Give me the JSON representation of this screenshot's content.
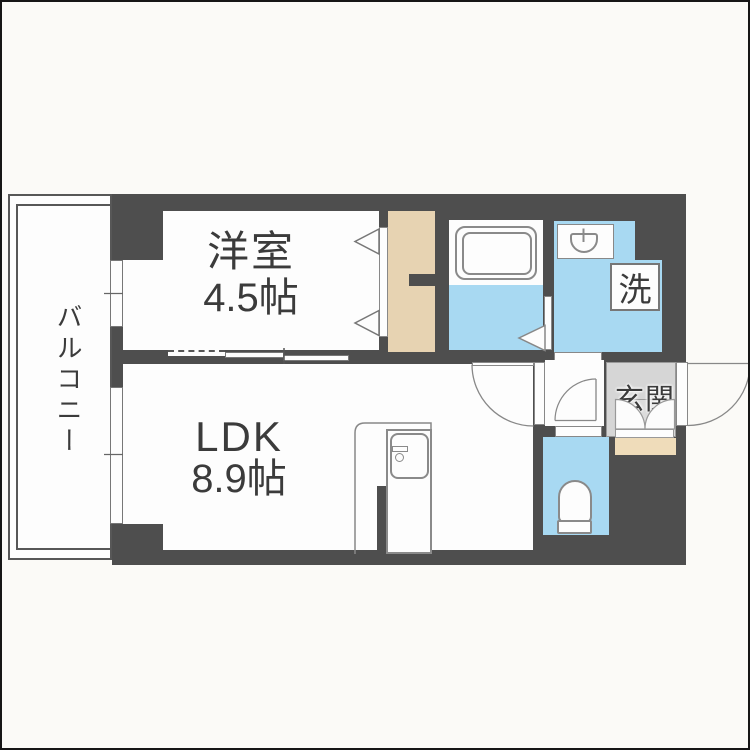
{
  "plan": {
    "bedroom": {
      "name": "洋室",
      "area": "4.5帖"
    },
    "ldk": {
      "name": "LDK",
      "area": "8.9帖"
    },
    "balcony": {
      "name": "バルコニー"
    },
    "entrance": {
      "name": "玄関"
    },
    "laundry": {
      "name": "洗"
    }
  },
  "colors": {
    "wall": "#4e4e4e",
    "water": "#a8d9f2",
    "closet": "#e7d3b2",
    "shoebox": "#efdcba",
    "entrance_floor": "#d6d6d6",
    "cabinet": "#dcdcdc",
    "text": "#3b3b3b",
    "bg": "#fbfaf7"
  }
}
